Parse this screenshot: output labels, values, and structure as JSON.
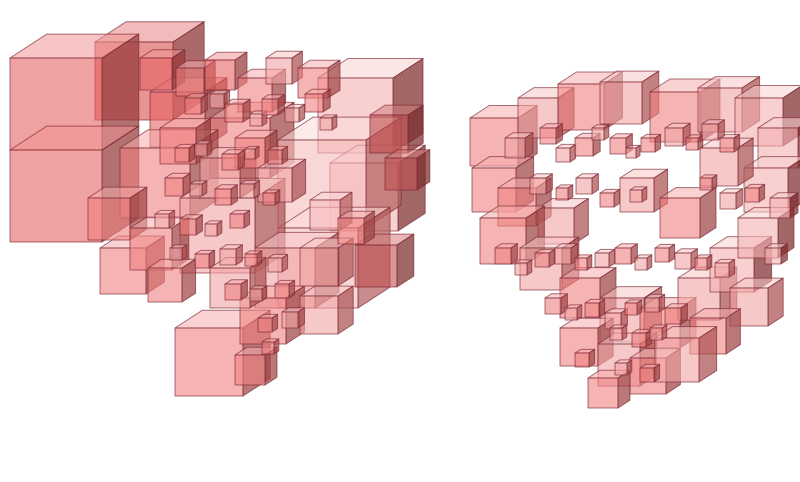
{
  "scene": {
    "background": "#ffffff",
    "edge_color": "#7b2531",
    "palette": [
      {
        "f": "#d94f4f",
        "t": "#e88484",
        "s": "#8c2f2f"
      },
      {
        "f": "#e66262",
        "t": "#f09595",
        "s": "#96393a"
      },
      {
        "f": "#ee8080",
        "t": "#f5adad",
        "s": "#a04545"
      },
      {
        "f": "#f2a3a3",
        "t": "#f8c6c6",
        "s": "#aa5252"
      },
      {
        "f": "#f6bcbc",
        "t": "#fbdada",
        "s": "#b46060"
      },
      {
        "f": "#c05050",
        "t": "#d47a7a",
        "s": "#7c2c2c"
      },
      {
        "f": "#f3b0b0",
        "t": "#f9d0d0",
        "s": "#7e2e2e"
      }
    ],
    "figures": [
      {
        "name": "left-cube-cluster",
        "cubes": [
          [
            95,
            42,
            78,
            0
          ],
          [
            318,
            78,
            75,
            6
          ],
          [
            330,
            163,
            68,
            6
          ],
          [
            10,
            58,
            92,
            1
          ],
          [
            10,
            150,
            92,
            1
          ],
          [
            150,
            92,
            55,
            1
          ],
          [
            210,
            118,
            60,
            2
          ],
          [
            120,
            148,
            70,
            2
          ],
          [
            278,
            140,
            88,
            4
          ],
          [
            278,
            228,
            80,
            4
          ],
          [
            180,
            198,
            75,
            3
          ],
          [
            100,
            248,
            46,
            2
          ],
          [
            88,
            198,
            42,
            2
          ],
          [
            255,
            248,
            60,
            3
          ],
          [
            130,
            228,
            42,
            2
          ],
          [
            370,
            115,
            38,
            5
          ],
          [
            385,
            158,
            32,
            5
          ],
          [
            355,
            245,
            42,
            5
          ],
          [
            175,
            328,
            68,
            2
          ],
          [
            240,
            298,
            46,
            2
          ],
          [
            210,
            268,
            40,
            3
          ],
          [
            300,
            296,
            38,
            3
          ],
          [
            235,
            355,
            30,
            2
          ],
          [
            140,
            58,
            32,
            1
          ],
          [
            176,
            68,
            28,
            2
          ],
          [
            205,
            60,
            30,
            1
          ],
          [
            238,
            78,
            34,
            2
          ],
          [
            266,
            58,
            26,
            3
          ],
          [
            298,
            68,
            30,
            2
          ],
          [
            160,
            128,
            36,
            2
          ],
          [
            200,
            158,
            40,
            3
          ],
          [
            235,
            138,
            30,
            2
          ],
          [
            258,
            168,
            34,
            3
          ],
          [
            300,
            248,
            38,
            3
          ],
          [
            148,
            268,
            34,
            2
          ],
          [
            310,
            200,
            30,
            4
          ],
          [
            338,
            218,
            26,
            2
          ],
          [
            185,
            98,
            16,
            2
          ],
          [
            210,
            94,
            14,
            3
          ],
          [
            225,
            104,
            18,
            2
          ],
          [
            250,
            114,
            12,
            3
          ],
          [
            262,
            99,
            16,
            2
          ],
          [
            285,
            108,
            14,
            3
          ],
          [
            305,
            94,
            18,
            2
          ],
          [
            320,
            118,
            12,
            3
          ],
          [
            175,
            148,
            14,
            2
          ],
          [
            195,
            144,
            12,
            3
          ],
          [
            222,
            154,
            16,
            2
          ],
          [
            245,
            149,
            10,
            3
          ],
          [
            268,
            150,
            14,
            2
          ],
          [
            165,
            178,
            18,
            2
          ],
          [
            190,
            184,
            12,
            3
          ],
          [
            215,
            189,
            16,
            2
          ],
          [
            240,
            184,
            14,
            3
          ],
          [
            263,
            193,
            12,
            2
          ],
          [
            155,
            214,
            14,
            3
          ],
          [
            180,
            219,
            16,
            2
          ],
          [
            205,
            224,
            12,
            3
          ],
          [
            230,
            214,
            14,
            2
          ],
          [
            170,
            248,
            12,
            3
          ],
          [
            195,
            254,
            14,
            2
          ],
          [
            220,
            249,
            16,
            3
          ],
          [
            245,
            254,
            12,
            2
          ],
          [
            268,
            258,
            14,
            3
          ],
          [
            225,
            284,
            16,
            2
          ],
          [
            250,
            289,
            12,
            3
          ],
          [
            275,
            284,
            14,
            2
          ],
          [
            258,
            318,
            14,
            2
          ],
          [
            282,
            312,
            16,
            3
          ],
          [
            262,
            342,
            12,
            2
          ]
        ]
      },
      {
        "name": "right-cube-cluster",
        "cubes": [
          [
            470,
            118,
            48,
            2
          ],
          [
            472,
            168,
            44,
            2
          ],
          [
            518,
            98,
            40,
            3
          ],
          [
            558,
            84,
            46,
            2
          ],
          [
            600,
            82,
            42,
            3
          ],
          [
            650,
            92,
            50,
            2
          ],
          [
            698,
            88,
            44,
            3
          ],
          [
            735,
            98,
            48,
            6
          ],
          [
            758,
            128,
            40,
            6
          ],
          [
            744,
            168,
            44,
            6
          ],
          [
            700,
            148,
            38,
            3
          ],
          [
            498,
            188,
            38,
            2
          ],
          [
            538,
            208,
            36,
            3
          ],
          [
            480,
            218,
            46,
            2
          ],
          [
            520,
            248,
            42,
            3
          ],
          [
            560,
            278,
            40,
            2
          ],
          [
            600,
            298,
            44,
            3
          ],
          [
            640,
            308,
            40,
            2
          ],
          [
            678,
            278,
            42,
            3
          ],
          [
            710,
            248,
            44,
            6
          ],
          [
            738,
            218,
            40,
            6
          ],
          [
            730,
            288,
            38,
            3
          ],
          [
            690,
            318,
            36,
            2
          ],
          [
            620,
            178,
            34,
            3
          ],
          [
            660,
            198,
            40,
            2
          ],
          [
            560,
            328,
            38,
            2
          ],
          [
            598,
            344,
            42,
            3
          ],
          [
            630,
            358,
            36,
            2
          ],
          [
            655,
            338,
            44,
            3
          ],
          [
            588,
            378,
            30,
            2
          ],
          [
            505,
            138,
            20,
            3
          ],
          [
            540,
            128,
            16,
            2
          ],
          [
            556,
            148,
            14,
            3
          ],
          [
            575,
            138,
            18,
            2
          ],
          [
            592,
            128,
            12,
            3
          ],
          [
            610,
            138,
            16,
            2
          ],
          [
            626,
            148,
            10,
            3
          ],
          [
            641,
            138,
            14,
            2
          ],
          [
            665,
            128,
            18,
            3
          ],
          [
            686,
            138,
            12,
            2
          ],
          [
            702,
            124,
            16,
            3
          ],
          [
            720,
            138,
            14,
            2
          ],
          [
            530,
            178,
            16,
            3
          ],
          [
            556,
            188,
            12,
            2
          ],
          [
            576,
            178,
            16,
            3
          ],
          [
            600,
            193,
            14,
            2
          ],
          [
            630,
            190,
            12,
            3
          ],
          [
            700,
            178,
            12,
            2
          ],
          [
            720,
            193,
            16,
            3
          ],
          [
            745,
            188,
            14,
            2
          ],
          [
            770,
            198,
            20,
            6
          ],
          [
            495,
            248,
            16,
            2
          ],
          [
            515,
            263,
            12,
            3
          ],
          [
            535,
            253,
            14,
            2
          ],
          [
            555,
            248,
            16,
            3
          ],
          [
            575,
            258,
            12,
            2
          ],
          [
            595,
            253,
            14,
            3
          ],
          [
            615,
            248,
            16,
            2
          ],
          [
            635,
            258,
            12,
            3
          ],
          [
            655,
            248,
            14,
            2
          ],
          [
            675,
            253,
            16,
            3
          ],
          [
            695,
            258,
            12,
            2
          ],
          [
            715,
            263,
            14,
            3
          ],
          [
            765,
            248,
            16,
            6
          ],
          [
            545,
            298,
            16,
            2
          ],
          [
            565,
            308,
            12,
            3
          ],
          [
            585,
            303,
            14,
            2
          ],
          [
            605,
            313,
            16,
            3
          ],
          [
            625,
            303,
            12,
            2
          ],
          [
            645,
            298,
            14,
            3
          ],
          [
            665,
            308,
            16,
            2
          ],
          [
            610,
            328,
            12,
            3
          ],
          [
            632,
            333,
            14,
            2
          ],
          [
            650,
            328,
            12,
            3
          ],
          [
            575,
            353,
            14,
            2
          ],
          [
            615,
            363,
            12,
            3
          ],
          [
            640,
            368,
            14,
            2
          ]
        ]
      }
    ]
  }
}
